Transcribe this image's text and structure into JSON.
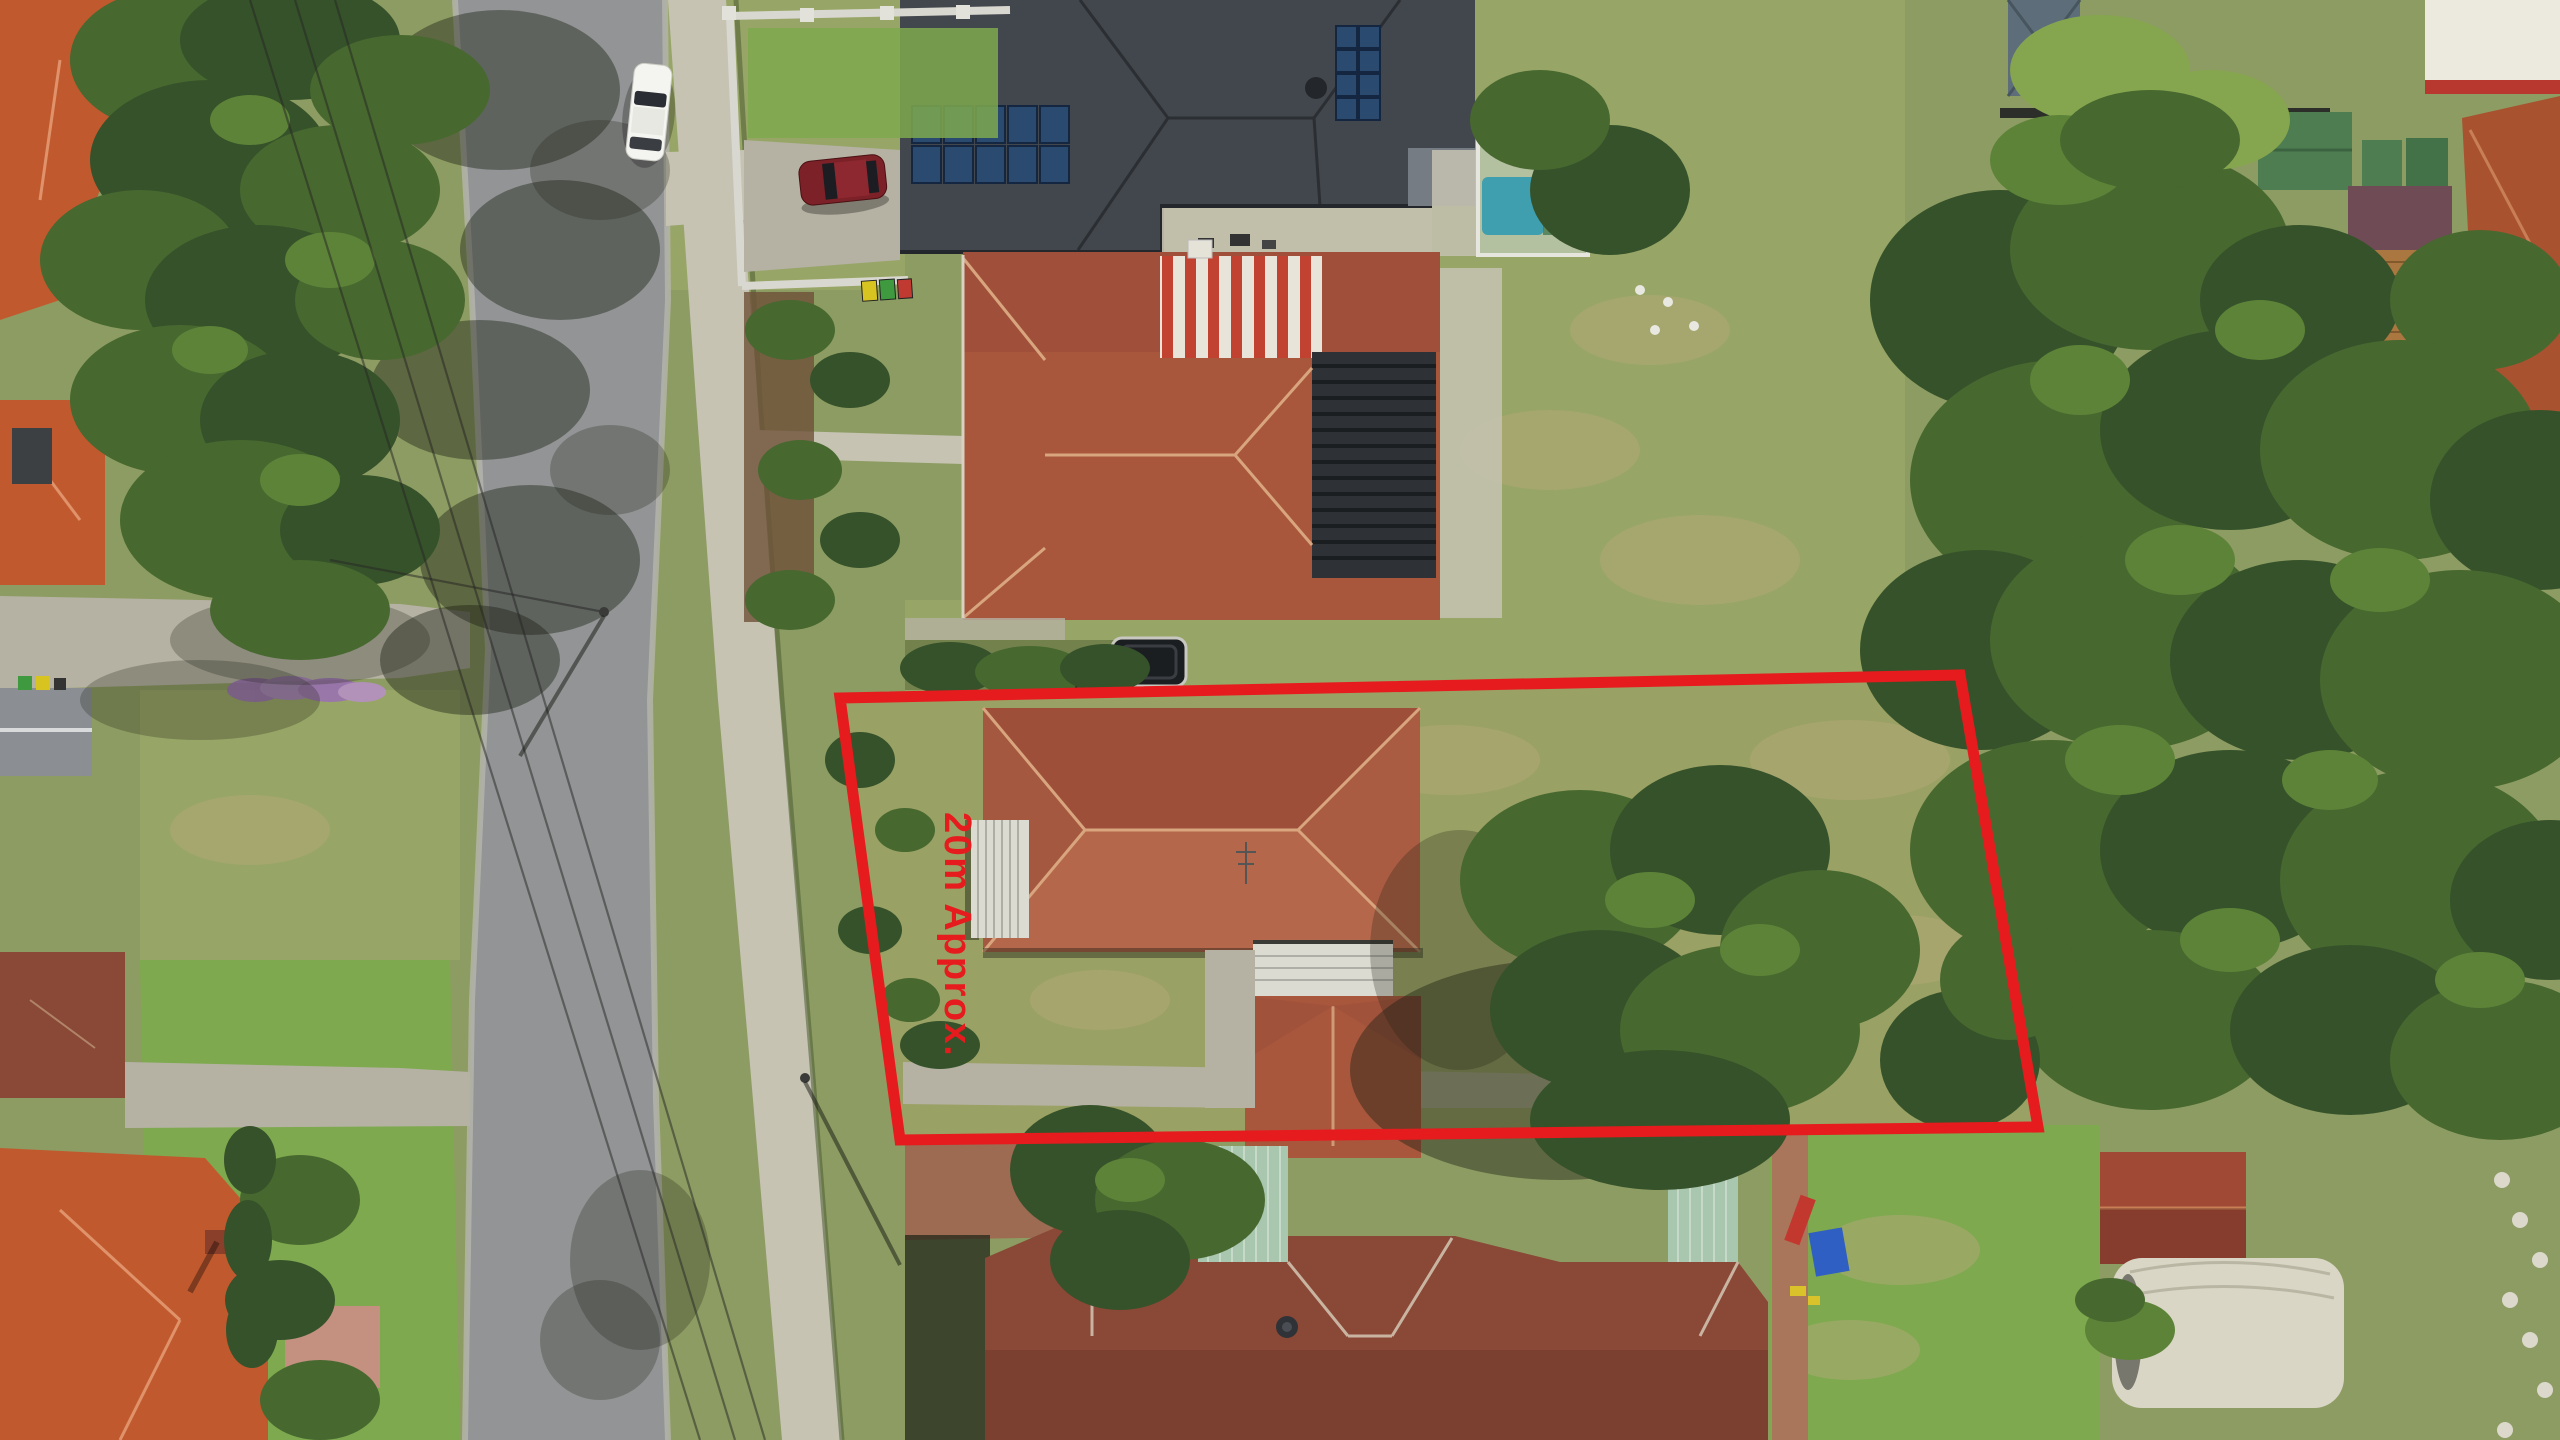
{
  "image": {
    "type": "aerial-drone-photograph",
    "description": "Top-down aerial photo of a suburban street block. A red outline highlights one residential lot containing a terracotta hip-roof house, white side awning, carport, rear building, lawn and large trees. Surroundings: a tree-lined road with a white car, a modern charcoal-roofed house with solar panels and a maroon car, a pool enclosure, terracotta-roofed neighbours, a red/white striped patio roof, a trampoline, dense tree canopy on the right, and a large brown-tiled unit complex with pale-green metal roof sections at the bottom.",
    "width_px": 2560,
    "height_px": 1440
  },
  "annotation": {
    "label": "20m Approx.",
    "color": "#e61b1e",
    "boundary_points": "840,698 1960,675 2038,1127 900,1140",
    "stroke_width": 11,
    "label_rotation_deg": 90
  },
  "palette": {
    "grass-base": "#8d9c62",
    "grass-verge": "#97a566",
    "grass-bright": "#7ea94f",
    "grass-dry": "#b3aa77",
    "tree-dark": "#36522a",
    "tree-mid": "#47682f",
    "tree-light": "#5d8338",
    "palm": "#85a64e",
    "road": "#929495",
    "concrete": "#c6c3b3",
    "concrete-dim": "#b5b2a3",
    "roof-orange": "#c05a2e",
    "roof-terra": "#a8573d",
    "roof-terra-light": "#b4674a",
    "roof-terra-dark": "#9d4f3a",
    "roof-brown": "#8a4836",
    "roof-charcoal": "#42474d",
    "roof-green": "#a9c6ae",
    "roof-red": "#a04a36",
    "panel-white": "#dcdbd1",
    "pool": "#3f9fae",
    "solar": "#2a4a70",
    "stripe-red": "#c24232",
    "stripe-white": "#e9e4da",
    "brick": "#9c6b52",
    "wood": "#a9773f"
  }
}
